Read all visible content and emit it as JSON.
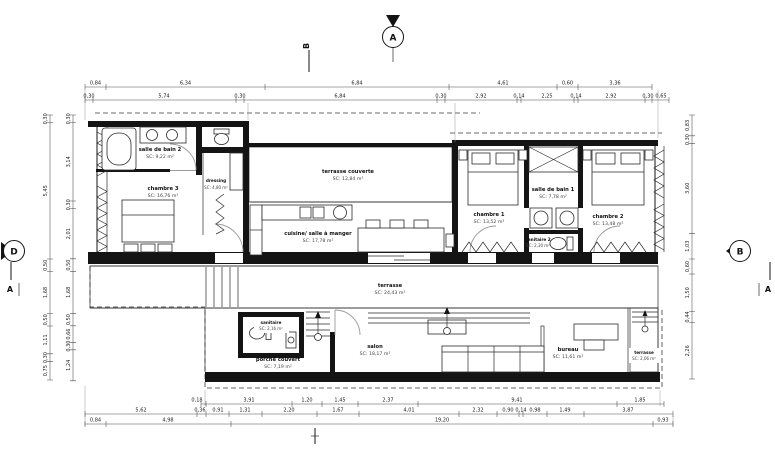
{
  "markers": {
    "top_a": "A",
    "top_b": "B",
    "left_d": "D",
    "left_a": "A",
    "right_b": "B",
    "right_a": "A"
  },
  "rooms": {
    "sdb2": {
      "name": "salle de bain 2",
      "area": "SC: 9,22 m²"
    },
    "ch3": {
      "name": "chambre 3",
      "area": "SC: 16,76 m²"
    },
    "dressing": {
      "name": "dressing",
      "area": "SC: 4,80 m²"
    },
    "terr_couv": {
      "name": "terrasse couverte",
      "area": "SC: 12,84 m²"
    },
    "cuisine": {
      "name": "cuisine/ salle à manger",
      "area": "SC: 17,78 m²"
    },
    "ch1": {
      "name": "chambre 1",
      "area": "SC: 13,52 m²"
    },
    "sdb1": {
      "name": "salle de bain 1",
      "area": "SC: 7,78 m²"
    },
    "san2": {
      "name": "sanitaire 2",
      "area": "SC: 2,30 m²"
    },
    "ch2": {
      "name": "chambre 2",
      "area": "SC: 13,48 m²"
    },
    "terrasse": {
      "name": "terrasse",
      "area": "SC: 24,43 m²"
    },
    "sanitaire": {
      "name": "sanitaire",
      "area": "SC: 2,16 m²"
    },
    "porche": {
      "name": "porche couvert",
      "area": "SC: 7,19 m²"
    },
    "salon": {
      "name": "salon",
      "area": "SC: 18,17 m²"
    },
    "bureau": {
      "name": "bureau",
      "area": "SC: 11,61 m²"
    },
    "terr_est": {
      "name": "terrasse",
      "area": "SC: 2,06 m²"
    }
  },
  "dims": {
    "top1": [
      "0,84",
      "6,34",
      "6,84",
      "4,61",
      "0,60",
      "3,36"
    ],
    "top2": [
      "0,30",
      "5,74",
      "0,30",
      "6,84",
      "0,30",
      "2,92",
      "0,14",
      "2,25",
      "0,14",
      "2,92",
      "0,30",
      "0,65"
    ],
    "bottom1": [
      "0,18",
      "3,91",
      "1,20",
      "1,45",
      "2,37",
      "9,41",
      "1,85"
    ],
    "bottom2": [
      "5,62",
      "0,36",
      "0,91",
      "1,31",
      "2,20",
      "1,67",
      "4,01",
      "2,32",
      "0,90",
      "0,14",
      "0,98",
      "1,49",
      "3,87"
    ],
    "bottom3": [
      "0,84",
      "4,98",
      "19,20",
      "0,93"
    ],
    "left_outer": [
      "0,30",
      "5,45",
      "0,50",
      "1,68",
      "0,50",
      "1,11",
      "0,30",
      "0,75"
    ],
    "left_inner": [
      "0,30",
      "3,14",
      "0,30",
      "2,01",
      "0,50",
      "1,68",
      "0,50",
      "0,66",
      "0,30",
      "1,24"
    ],
    "right": [
      "0,83",
      "0,30",
      "3,60",
      "1,03",
      "0,60",
      "1,50",
      "0,44",
      "2,26"
    ]
  }
}
